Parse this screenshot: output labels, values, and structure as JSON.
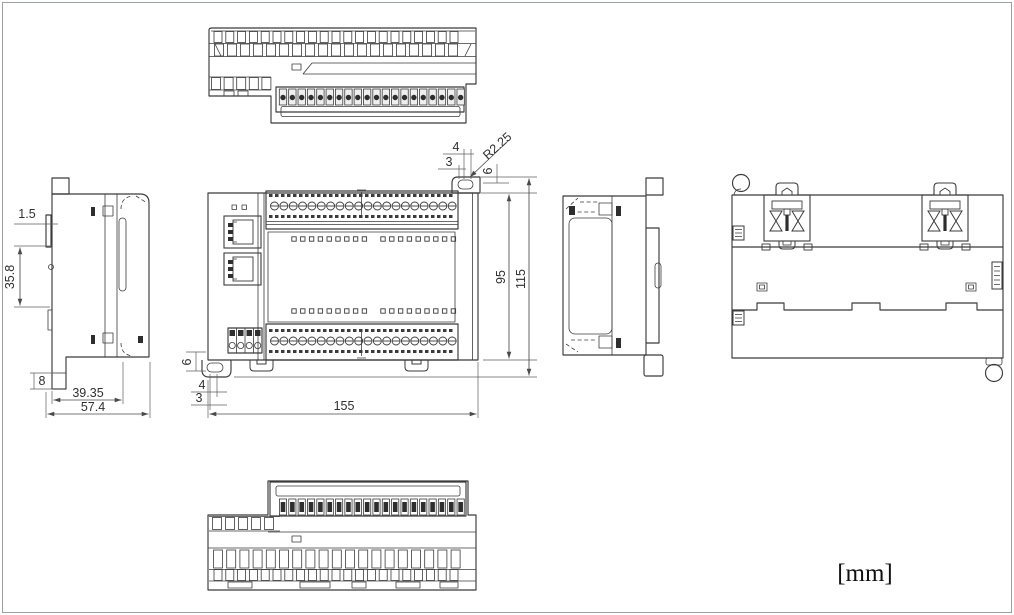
{
  "drawing": {
    "unit_label": "[mm]",
    "dimensions": {
      "side_view": {
        "plate": "1.5",
        "mount_span": "35.8",
        "foot": "8",
        "rail_depth": "39.35",
        "total_depth": "57.4"
      },
      "front_view": {
        "ear_offset_a": "4",
        "ear_offset_b": "3",
        "ear_radius": "R2.25",
        "ear_height_top": "6",
        "body_height": "95",
        "total_height": "115",
        "ear_height_bottom": "6",
        "ear_offset_c": "4",
        "ear_offset_d": "3",
        "total_width": "155"
      }
    }
  }
}
